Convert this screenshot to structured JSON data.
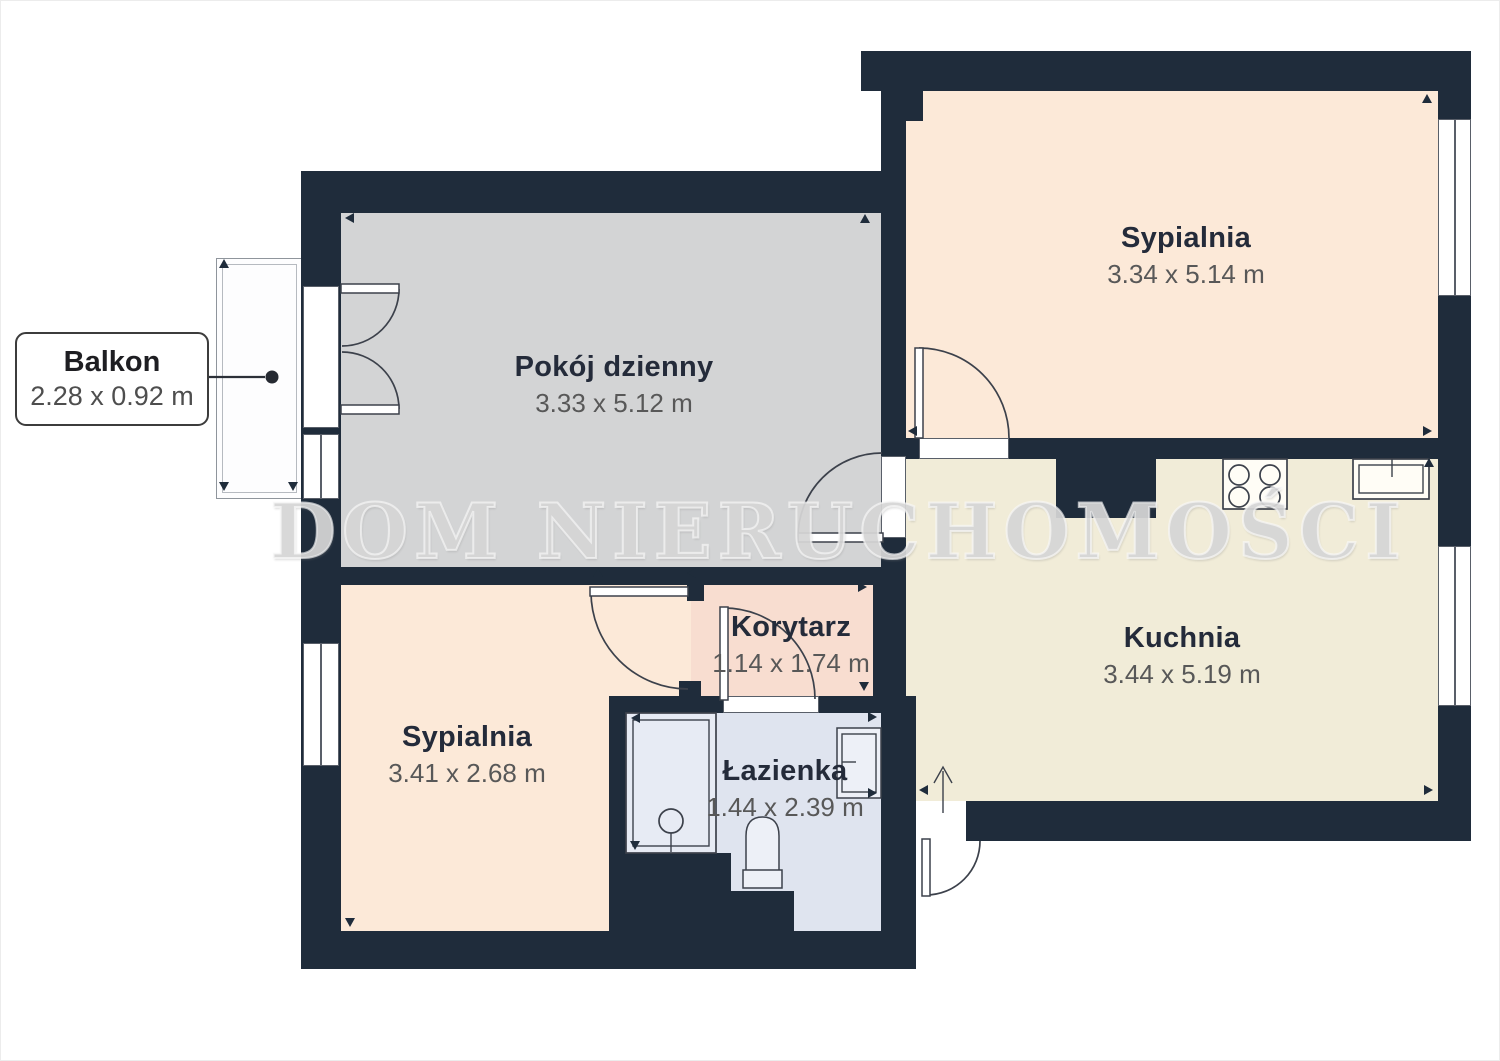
{
  "watermark": "DOM NIERUCHOMOŚCI",
  "balcony_label": {
    "name": "Balkon",
    "dims": "2.28 x 0.92 m"
  },
  "rooms": [
    {
      "key": "living",
      "name": "Pokój dzienny",
      "dims": "3.33 x 5.12 m"
    },
    {
      "key": "bedroom1",
      "name": "Sypialnia",
      "dims": "3.34 x 5.14 m"
    },
    {
      "key": "kitchen",
      "name": "Kuchnia",
      "dims": "3.44 x 5.19 m"
    },
    {
      "key": "hallway",
      "name": "Korytarz",
      "dims": "1.14 x 1.74 m"
    },
    {
      "key": "bedroom2",
      "name": "Sypialnia",
      "dims": "3.41 x 2.68 m"
    },
    {
      "key": "bathroom",
      "name": "Łazienka",
      "dims": "1.44 x 2.39 m"
    }
  ],
  "colors": {
    "wall": "#1f2c3b",
    "living_floor": "#d3d4d5",
    "bedroom_floor": "#fce9d8",
    "kitchen_floor": "#f1ecd8",
    "hallway_floor": "#f8ddd0",
    "bathroom_floor": "#dfe4ef",
    "balcony_fill": "#fdfdfe",
    "outline": "#3c414b",
    "label_title": "#242b3a",
    "label_dims": "#585858",
    "watermark_color": "#d6d6d6"
  }
}
